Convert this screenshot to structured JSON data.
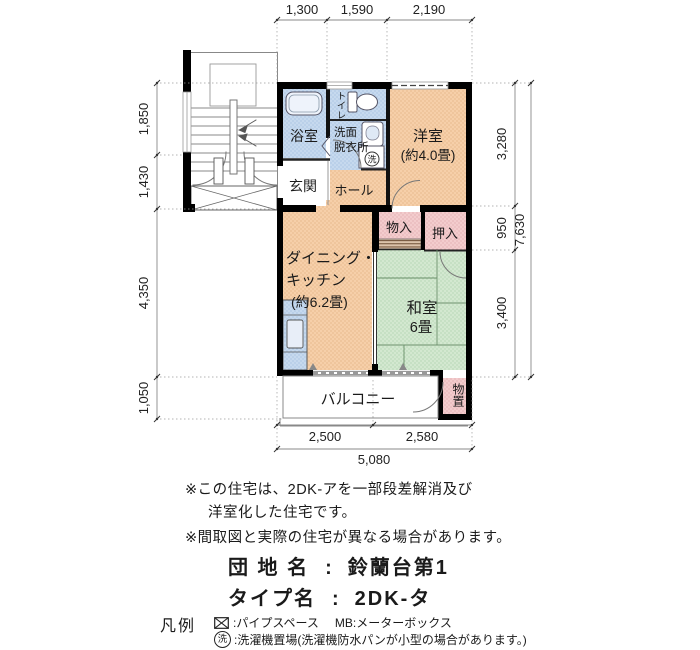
{
  "plan": {
    "rooms": {
      "bath": "浴室",
      "toilet": "トイレ",
      "wash1": "洗面",
      "wash2": "脱衣所",
      "washer_symbol": "洗",
      "western": "洋室",
      "western_size": "(約4.0畳)",
      "entrance": "玄関",
      "hall": "ホール",
      "storage": "物入",
      "closet": "押入",
      "dk1": "ダイニング・",
      "dk2": "キッチン",
      "dk_size": "(約6.2畳)",
      "japanese": "和室",
      "japanese_size": "6畳",
      "balcony": "バルコニー",
      "outdoor_storage": "物置"
    },
    "dimensions": {
      "top": [
        "1,300",
        "1,590",
        "2,190"
      ],
      "left": [
        "1,850",
        "1,430",
        "4,350",
        "1,050"
      ],
      "right": [
        "3,280",
        "950",
        "3,400"
      ],
      "right_total": "7,630",
      "bottom": [
        "2,500",
        "2,580"
      ],
      "bottom_total": "5,080"
    }
  },
  "notes": {
    "line1": "※この住宅は、2DK-アを一部段差解消及び",
    "line2": "洋室化した住宅です。",
    "line3": "※間取図と実際の住宅が異なる場合があります。"
  },
  "info": {
    "estate_label": "団 地 名",
    "estate_colon": ":",
    "estate_value": "鈴蘭台第1",
    "type_label": "タイプ名",
    "type_colon": ":",
    "type_value": "2DK-タ"
  },
  "legend": {
    "title": "凡例",
    "pipe_text": ":パイプスペース",
    "mb_text": "MB:メーターボックス",
    "washer_symbol": "洗",
    "washer_text": ":洗濯機置場(洗濯機防水パンが小型の場合があります。)"
  },
  "colors": {
    "room_peach": "#f5cda6",
    "wet_blue": "#c5d8ee",
    "tatami_green": "#d2e7d0",
    "closet_pink": "#f3cbcd",
    "wall": "#000000"
  }
}
